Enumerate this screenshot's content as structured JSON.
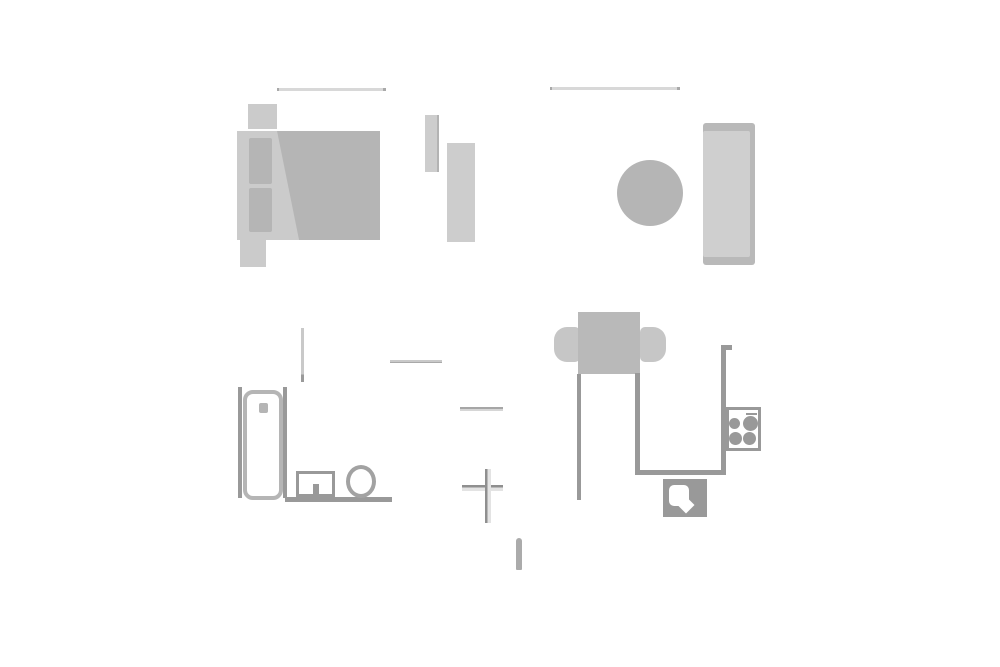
{
  "scene": {
    "type": "floor-plan",
    "background": "#ffffff",
    "visible_text": []
  },
  "palette": {
    "light": "#cbcbcb",
    "mid": "#b5b5b5",
    "wardrobe": "#cdcdcd",
    "sofa_outer": "#b9b9b9",
    "sofa_inner": "#cfcfcf",
    "chair": "#c6c6c6",
    "table": "#b9b9b9",
    "fixture": "#999999",
    "toilet": "#a2a2a2",
    "thin_line": "#d8d8d8",
    "thin_line_cap": "#a9a9a9",
    "hall_line": "#c9c9c9",
    "cross_dark": "#8f8f8f",
    "cross_light": "#e3e3e3",
    "stick": "#ababab",
    "bg": "#ffffff"
  },
  "symbols": [
    {
      "name": "window-bedroom-icon",
      "kind": "window-line"
    },
    {
      "name": "nightstand-icon",
      "kind": "furniture"
    },
    {
      "name": "double-bed-icon",
      "kind": "furniture"
    },
    {
      "name": "bed-pillow-icon",
      "kind": "furniture-detail"
    },
    {
      "name": "bed-blanket-icon",
      "kind": "furniture-detail"
    },
    {
      "name": "bed-bench-icon",
      "kind": "furniture"
    },
    {
      "name": "wardrobe-small-icon",
      "kind": "furniture"
    },
    {
      "name": "wardrobe-large-icon",
      "kind": "furniture"
    },
    {
      "name": "window-living-icon",
      "kind": "window-line"
    },
    {
      "name": "round-side-table-icon",
      "kind": "furniture"
    },
    {
      "name": "sofa-icon",
      "kind": "furniture"
    },
    {
      "name": "dining-table-icon",
      "kind": "furniture"
    },
    {
      "name": "dining-chair-icon",
      "kind": "furniture"
    },
    {
      "name": "kitchen-counter-outline",
      "kind": "fixture-line"
    },
    {
      "name": "stove-icon",
      "kind": "appliance"
    },
    {
      "name": "stove-burner-icon",
      "kind": "appliance-detail"
    },
    {
      "name": "kitchen-sink-icon",
      "kind": "appliance"
    },
    {
      "name": "shower-cabin-icon",
      "kind": "fixture"
    },
    {
      "name": "washbasin-icon",
      "kind": "fixture"
    },
    {
      "name": "toilet-icon",
      "kind": "fixture"
    },
    {
      "name": "bathroom-wall-line",
      "kind": "fixture-line"
    },
    {
      "name": "door-marker-line",
      "kind": "marker"
    },
    {
      "name": "cross-marker-icon",
      "kind": "marker"
    },
    {
      "name": "door-stop-marker-icon",
      "kind": "marker"
    }
  ]
}
